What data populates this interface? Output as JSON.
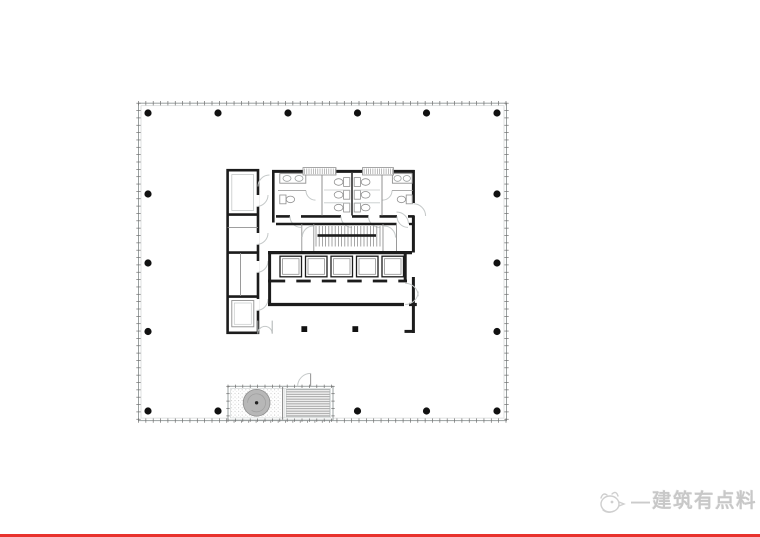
{
  "page": {
    "background": "#ffffff",
    "width": 760,
    "height": 537
  },
  "watermark": {
    "icon": "bird-doodle-icon",
    "dash": "—",
    "text": "建筑有点料",
    "color": "#c8c8c8"
  },
  "footer_rule": {
    "color": "#e8322d",
    "height": 3
  },
  "plan": {
    "type": "architectural-floor-plan",
    "description": "Typical office tower floor plan: curtain-wall boundary with mullion ticks, perimeter column grid, central service core (toilets, scissor stair, 5-car elevator bank, west service rooms) and a detached louvered fan/cooling enclosure on the south edge",
    "colors": {
      "wall": "#1c1c1c",
      "thin_line": "#909090",
      "light_line": "#c5c9c9",
      "boundary": "#9aa0a0",
      "boundary_inner": "#d2d6d6",
      "tick": "#6f6f6f",
      "column": "#111111",
      "fan_fill": "#b7b7b7",
      "fan_edge": "#8d8d8d",
      "louver": "#8f8f8f"
    },
    "boundary": {
      "x": 138.5,
      "y": 103.2,
      "width": 368,
      "height": 317.4
    },
    "tick_rects": [
      {
        "id": "boundary-ticks",
        "x": 138.5,
        "y": 103.2,
        "w": 368,
        "h": 317.4,
        "spacing": 7.35,
        "len": 2.2
      },
      {
        "id": "annex-ticks",
        "x": 228,
        "y": 386.3,
        "w": 105,
        "h": 33.9,
        "spacing": 7.4,
        "len": 1.7
      }
    ],
    "column_grid": {
      "dot_radius": 3.6,
      "rows": [
        {
          "y": 113,
          "x": [
            148,
            218,
            288,
            357.5,
            426.5,
            497
          ]
        },
        {
          "y": 194,
          "x": [
            148,
            497
          ]
        },
        {
          "y": 263,
          "x": [
            148,
            497
          ]
        },
        {
          "y": 331.5,
          "x": [
            148,
            497
          ]
        },
        {
          "y": 411,
          "x": [
            148,
            218,
            288,
            357.5,
            426.5,
            497
          ]
        }
      ]
    },
    "core": {
      "elevator_count": 5,
      "toilet_stall_rows": 3,
      "vent_count": 2
    },
    "elevators": {
      "xs": [
        280,
        305.5,
        331,
        356.5,
        382
      ],
      "y": 256.2,
      "w": 21.5,
      "h": 20.6,
      "door_y": 279.6,
      "door_dash_h": 2.8,
      "lobby_x2": 407
    },
    "stair_treads": {
      "x1": 316,
      "x2": 380,
      "step": 3.2,
      "y1": 226,
      "y2": 246.5
    },
    "wc_stalls": {
      "rows": 3,
      "y0": 177.6,
      "dy": 12.8,
      "left_tank_x": 343.6,
      "right_tank_x": 354.2,
      "tank_w": 6.2,
      "tank_h": 8.8,
      "left_bowl_cx": 338.6,
      "right_bowl_cx": 365.6,
      "part_y1": 190,
      "part_y2": 202.8
    },
    "vents": [
      {
        "x": 303,
        "y": 167.6,
        "w": 33,
        "h": 7.4
      },
      {
        "x": 362.5,
        "y": 167.6,
        "w": 31,
        "h": 7.4
      }
    ],
    "annex": {
      "x": 228,
      "y": 386.3,
      "width": 105,
      "height": 33.9,
      "fan_center": [
        256.6,
        402.8
      ],
      "fan_radius": 13.4
    }
  }
}
